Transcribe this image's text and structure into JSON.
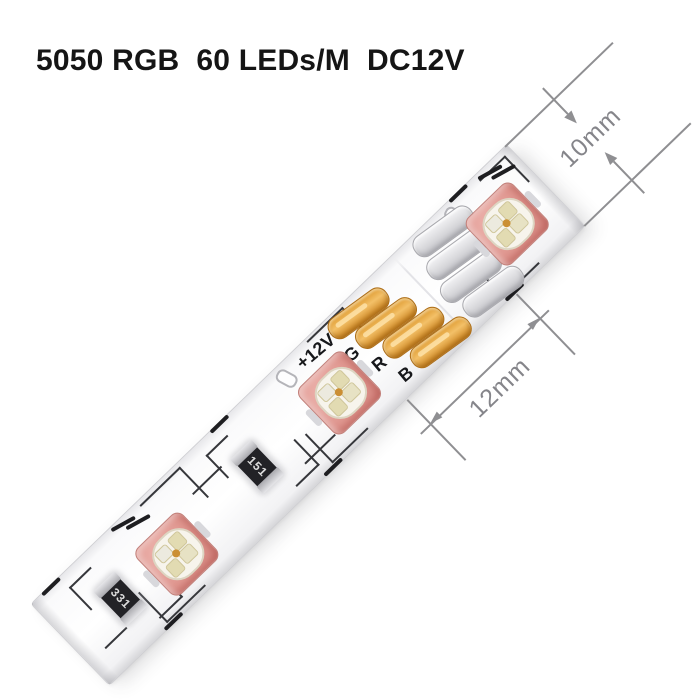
{
  "title": "5050 RGB  60 LEDs/M  DC12V",
  "strip": {
    "pad_labels": [
      "+12V",
      "G",
      "R",
      "B"
    ],
    "resistors": [
      {
        "code": "331"
      },
      {
        "code": "151"
      }
    ],
    "led_count_visible": 3
  },
  "dimensions": {
    "width_label": "10mm",
    "segment_label": "12mm"
  },
  "colors": {
    "copper_pad": "#e3a23f",
    "led_package": "#df968f",
    "dimension_lines": "#8f8f92",
    "title_text": "#151515",
    "trace": "#36373b"
  }
}
